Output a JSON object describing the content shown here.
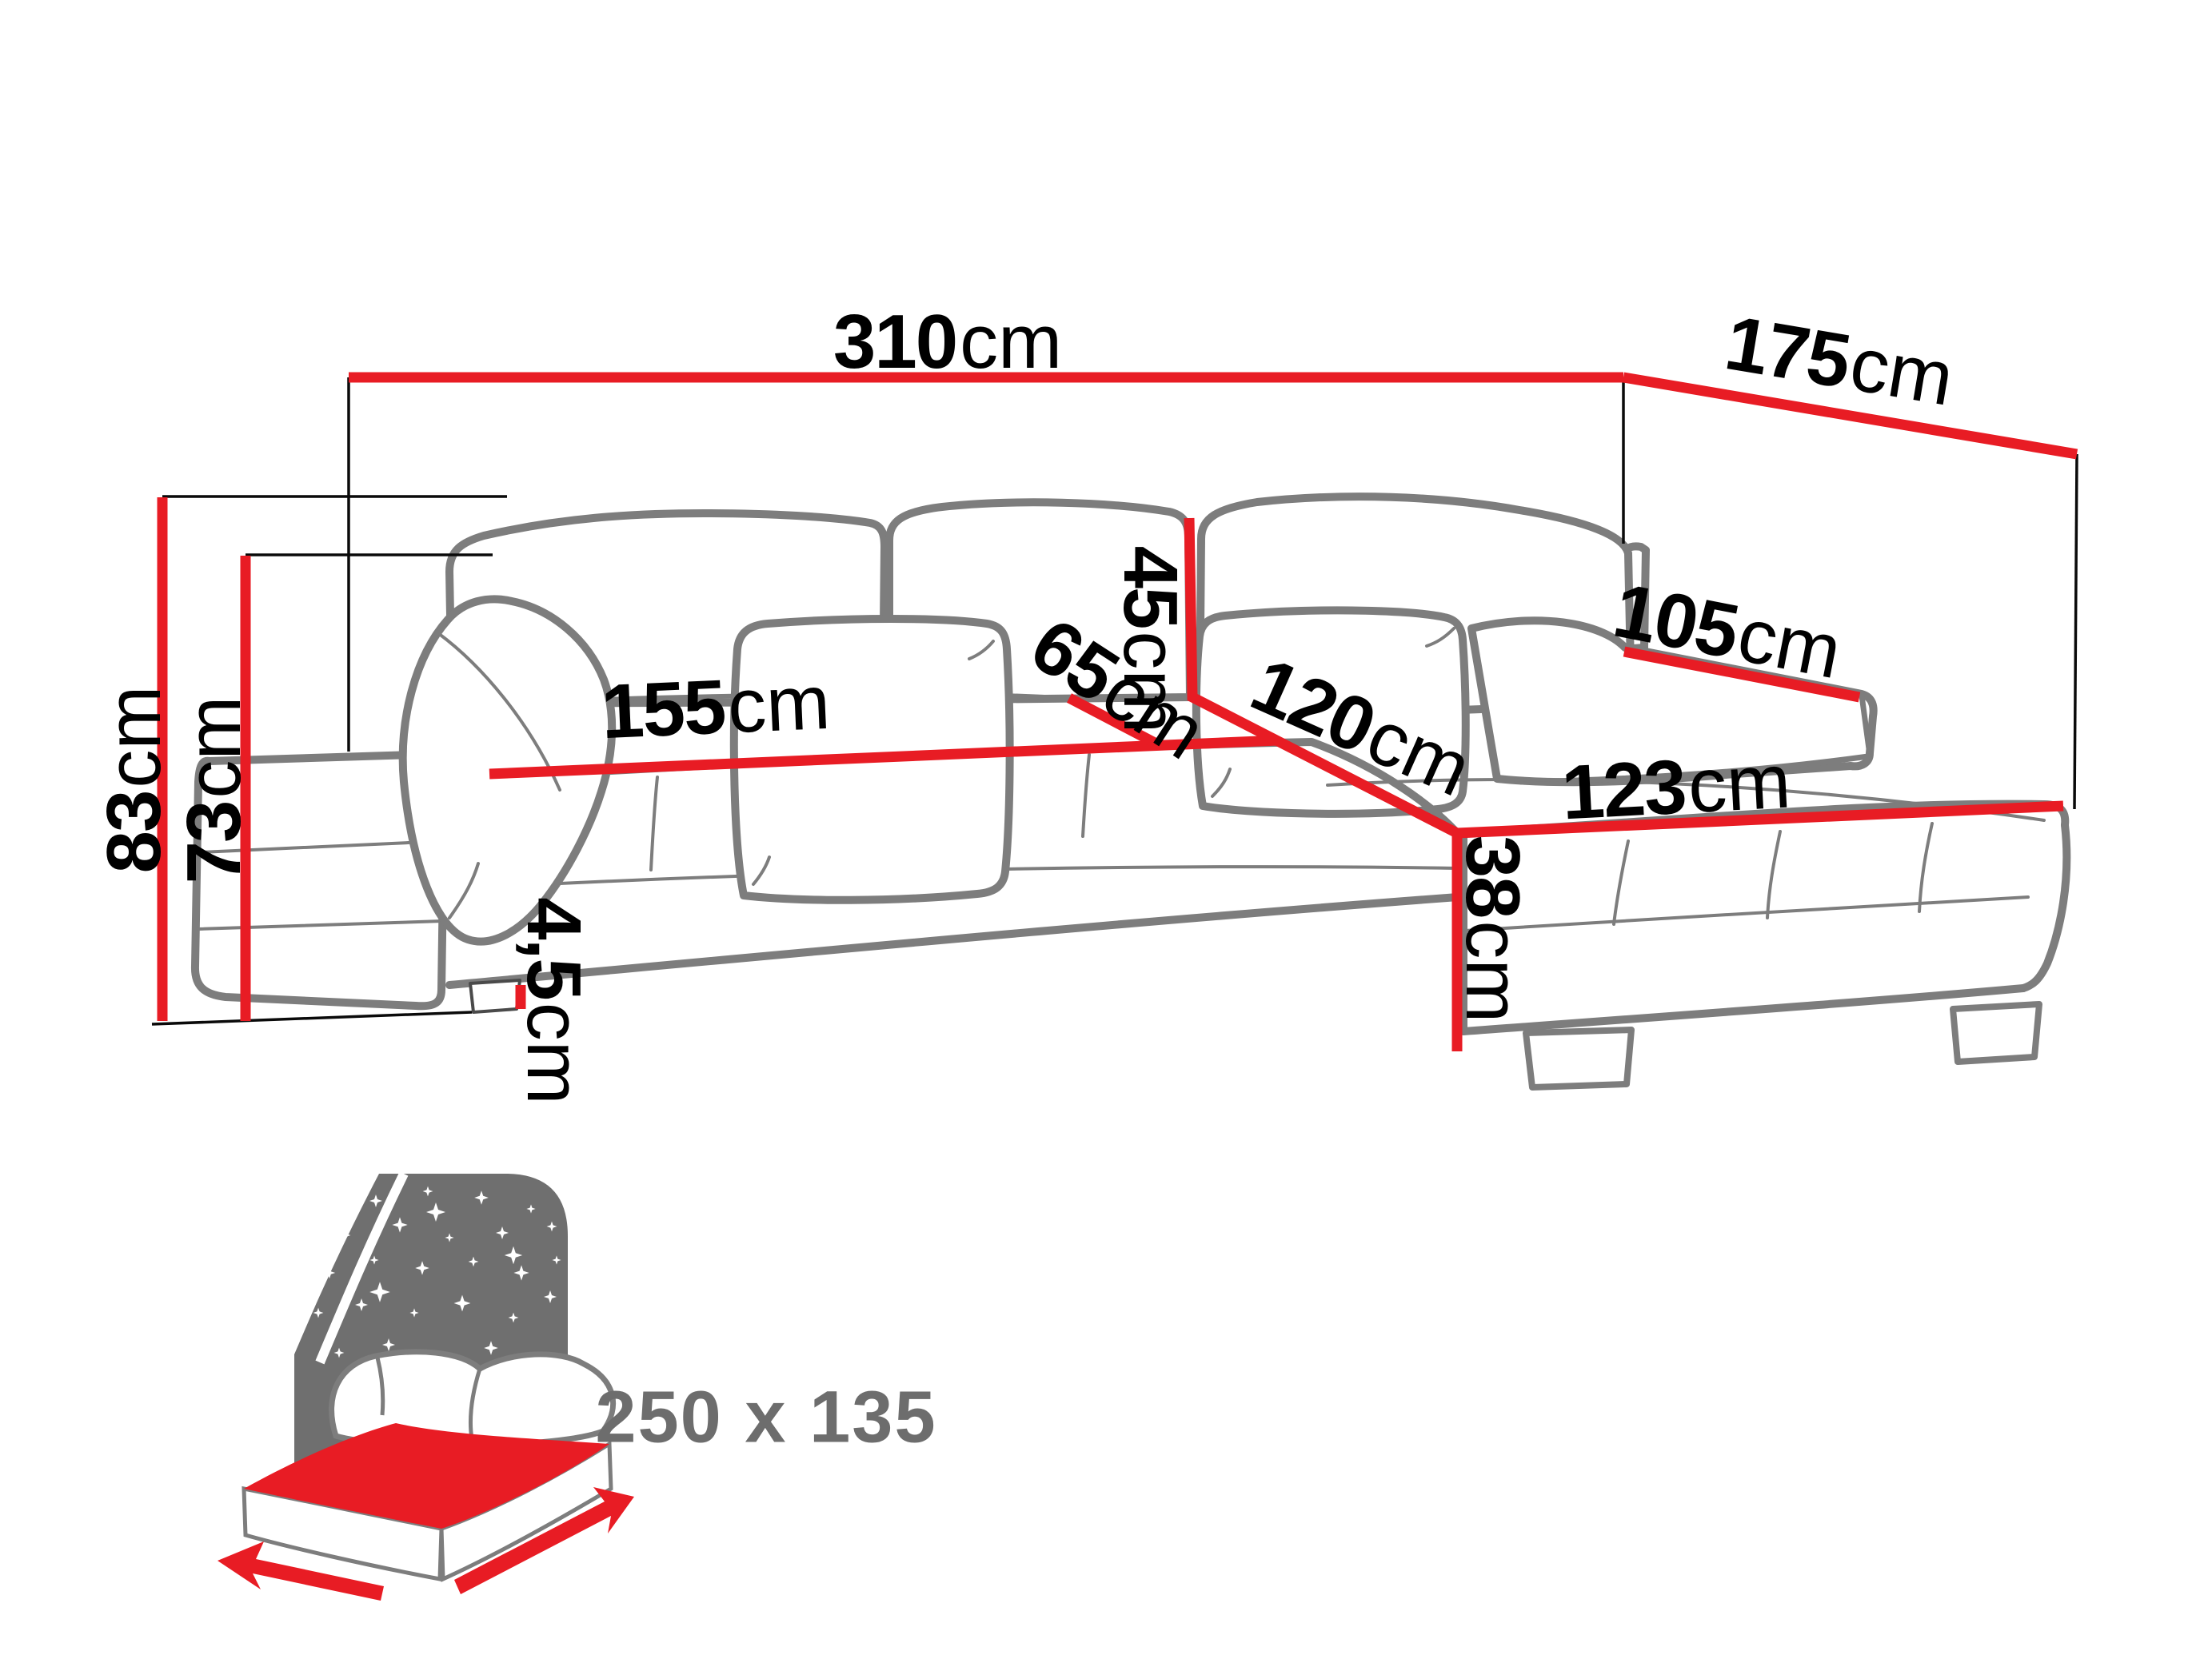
{
  "diagram_title": "corner-sofa-dimension-diagram",
  "colors": {
    "dimension_red": "#e81c24",
    "sofa_outline_gray": "#7d7d7d",
    "icon_gray": "#6f6f6f",
    "label_black": "#000000"
  },
  "dimensions": {
    "total_width": {
      "value": "310",
      "unit": "cm"
    },
    "total_depth": {
      "value": "175",
      "unit": "cm"
    },
    "total_height": {
      "value": "83",
      "unit": "cm"
    },
    "armrest_height": {
      "value": "73",
      "unit": "cm"
    },
    "seat_length": {
      "value": "155",
      "unit": "cm"
    },
    "seat_depth": {
      "value": "65",
      "unit": "cm"
    },
    "backrest_height": {
      "value": "45",
      "unit": "cm"
    },
    "corner_width": {
      "value": "120",
      "unit": "cm"
    },
    "chaise_length": {
      "value": "123",
      "unit": "cm"
    },
    "armrest_length": {
      "value": "105",
      "unit": "cm"
    },
    "seat_height": {
      "value": "38",
      "unit": "cm"
    },
    "leg_height": {
      "value": "4,5",
      "unit": "cm"
    }
  },
  "sleeping_area": {
    "label": "250 x 135"
  }
}
